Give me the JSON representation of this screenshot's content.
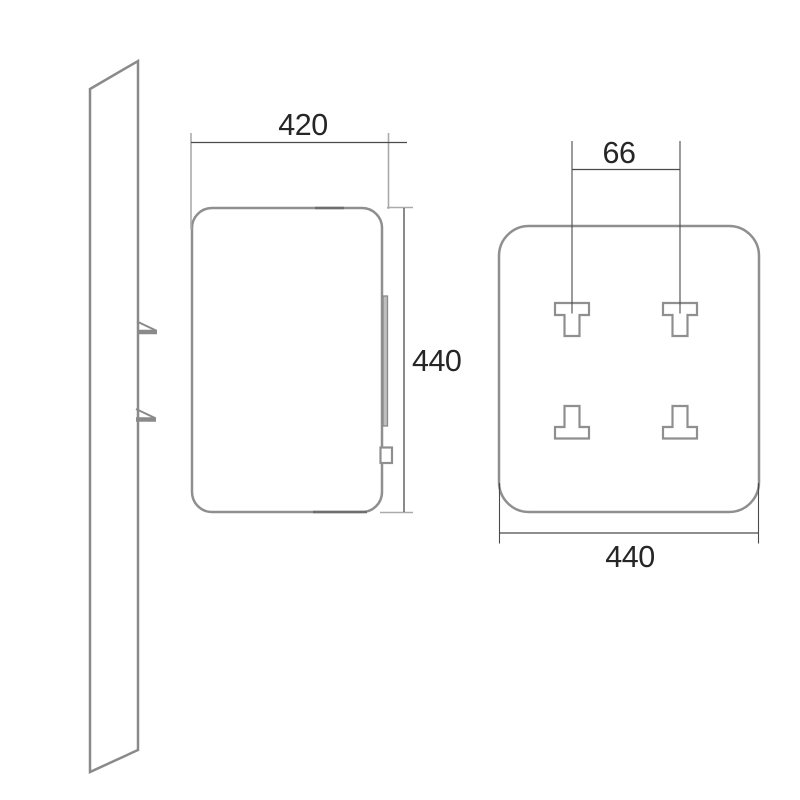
{
  "diagram": {
    "front_view": {
      "width_label": "420",
      "height_label": "440"
    },
    "back_view": {
      "bracket_spacing_label": "66",
      "width_label": "440"
    }
  },
  "colors": {
    "background": "#ffffff",
    "object_outline": "#8f8f8f",
    "wall_hatch": "#8a8a8a",
    "dimension_line": "#4a4a4a",
    "extension_line_light": "#ababab",
    "label_text": "#262626"
  }
}
